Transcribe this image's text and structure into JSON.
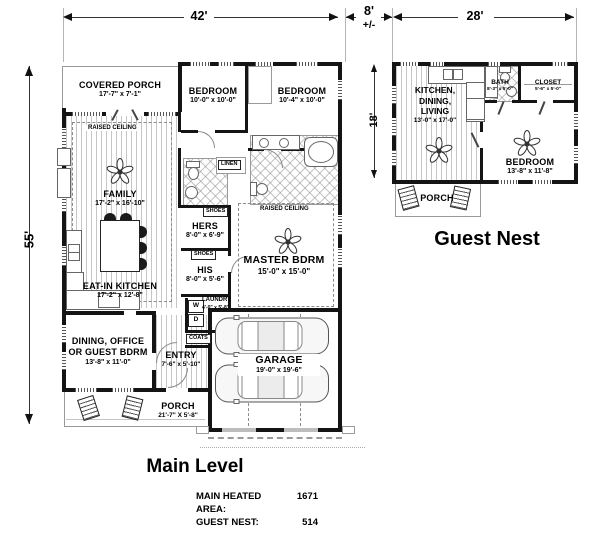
{
  "dims": {
    "w42": "42'",
    "w8": "8'",
    "pm": "+/-",
    "w28": "28'",
    "h55": "55'",
    "h18": "18'"
  },
  "main": {
    "title": "Main Level",
    "covered_porch_name": "COVERED PORCH",
    "covered_porch_size": "17'-7\" x 7'-1\"",
    "bedroom1_name": "BEDROOM",
    "bedroom1_size": "10'-0\" x 10'-0\"",
    "bedroom2_name": "BEDROOM",
    "bedroom2_size": "10'-4\" x 10'-0\"",
    "family_name": "FAMILY",
    "family_size": "17'-2\" x 16'-10\"",
    "kitchen_name": "EAT-IN KITCHEN",
    "kitchen_size": "17'-2\" x 12'-8\"",
    "hers_name": "HERS",
    "hers_size": "8'-0\" x 6'-9\"",
    "his_name": "HIS",
    "his_size": "8'-0\" x 5'-6\"",
    "master_name": "MASTER BDRM",
    "master_size": "15'-0\" x 15'-0\"",
    "laundry_name": "LAUNDRY",
    "laundry_size": "4'-0\" x 5'-8\"",
    "dining_name1": "DINING, OFFICE",
    "dining_name2": "OR GUEST BDRM",
    "dining_size": "13'-8\" x 11'-0\"",
    "entry_name": "ENTRY",
    "entry_size": "7'-6\" x 5'-10\"",
    "garage_name": "GARAGE",
    "garage_size": "19'-0\" x 19'-6\"",
    "porch_name": "PORCH",
    "porch_size": "21'-7\" X 5'-8\"",
    "raised_ceiling": "RAISED CEILING",
    "linen": "LINEN",
    "shoes": "SHOES",
    "coats": "COATS",
    "washer": "W",
    "dryer": "D"
  },
  "guest": {
    "title": "Guest Nest",
    "kdl_name1": "KITCHEN,",
    "kdl_name2": "DINING,",
    "kdl_name3": "LIVING",
    "kdl_size": "13'-0\" x 17'-0\"",
    "bath_name": "BATH",
    "bath_size": "8'-3\" x 5'-0\"",
    "closet_name": "CLOSET",
    "closet_size": "5'-6\" x 5'-0\"",
    "bedroom_name": "BEDROOM",
    "bedroom_size": "13'-8\" x 11'-8\"",
    "porch_name": "PORCH"
  },
  "summary": {
    "area_label": "MAIN HEATED AREA:",
    "area_value": "1671",
    "guest_label": "GUEST NEST:",
    "guest_value": "514"
  }
}
